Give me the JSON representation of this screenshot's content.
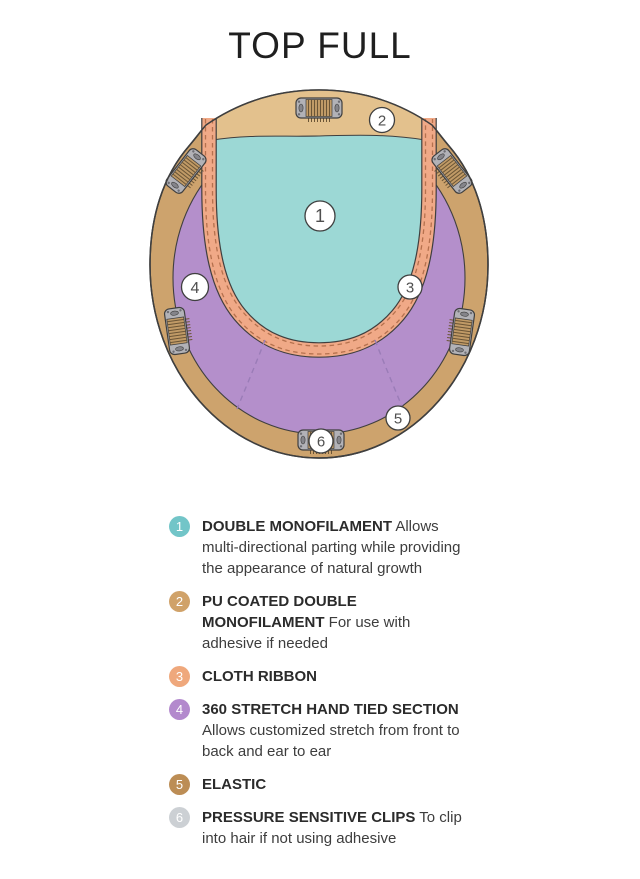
{
  "title": "TOP FULL",
  "colors": {
    "elastic_tan": "#cda36d",
    "pu_tan": "#e3c18d",
    "mono_teal": "#9cd8d5",
    "hand_tied_purple": "#b48fcb",
    "ribbon_peach": "#f0a987",
    "outline": "#3f3f3f",
    "stitch": "#b5714e",
    "seam": "#9a7cb7",
    "clip_gray": "#b2b2b7",
    "clip_teeth": "#c09a66",
    "clip_detail": "#6b5536",
    "callout_fill": "#ffffff"
  },
  "diagram": {
    "callouts": [
      {
        "number": "1"
      },
      {
        "number": "2"
      },
      {
        "number": "3"
      },
      {
        "number": "4"
      },
      {
        "number": "5"
      },
      {
        "number": "6"
      }
    ]
  },
  "legend": {
    "items": [
      {
        "number": "1",
        "color": "#72c5c8",
        "label": "DOUBLE MONOFILAMENT",
        "description": "Allows multi-directional parting while providing the appearance of natural growth"
      },
      {
        "number": "2",
        "color": "#d0a269",
        "label": "PU COATED DOUBLE MONOFILAMENT",
        "description": "For use with adhesive if needed"
      },
      {
        "number": "3",
        "color": "#efa87c",
        "label": "CLOTH RIBBON",
        "description": ""
      },
      {
        "number": "4",
        "color": "#b389cd",
        "label": "360 STRETCH HAND TIED SECTION",
        "description": "Allows customized stretch from front to back and ear to ear"
      },
      {
        "number": "5",
        "color": "#bc8d55",
        "label": "ELASTIC",
        "description": ""
      },
      {
        "number": "6",
        "color": "#ccd0d4",
        "label": "PRESSURE SENSITIVE CLIPS",
        "description": "To clip into hair if not using adhesive"
      }
    ]
  }
}
